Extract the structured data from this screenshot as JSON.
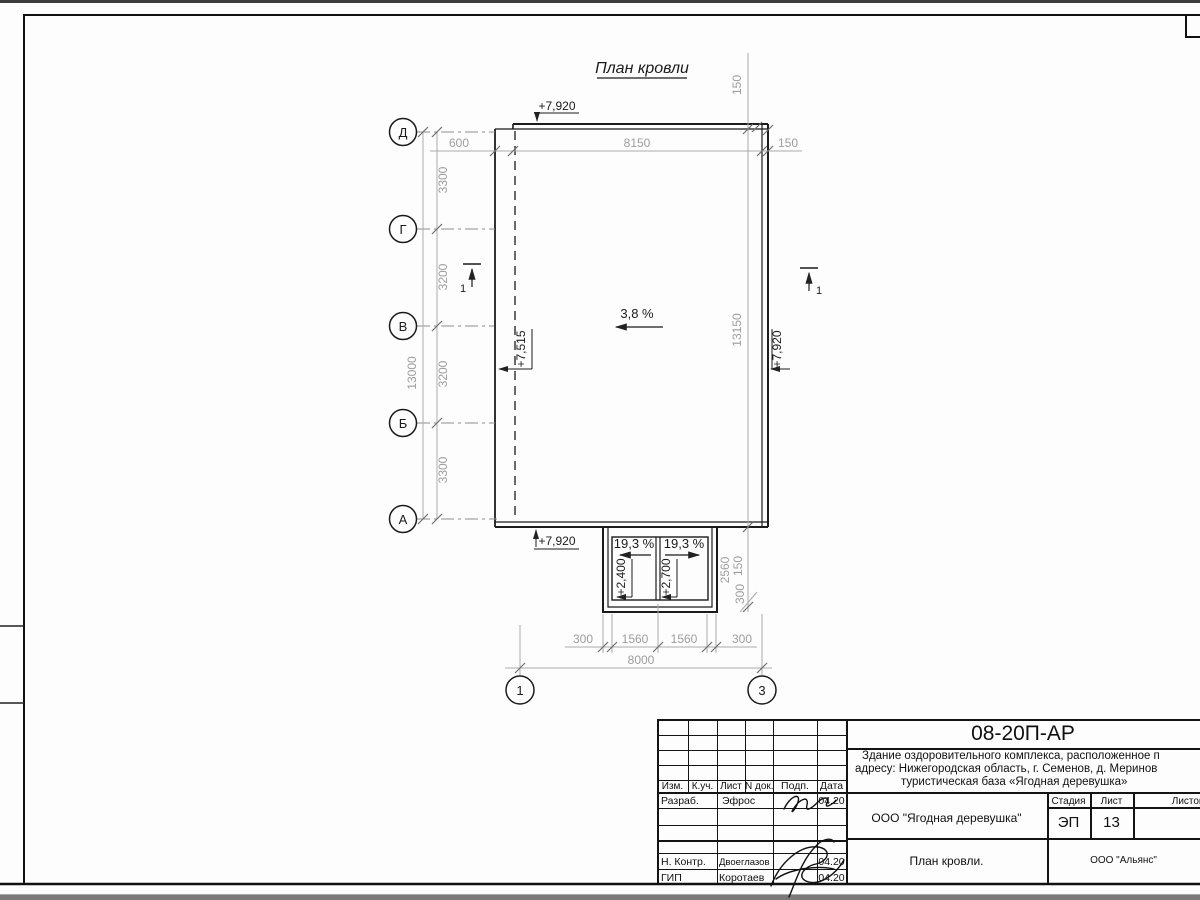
{
  "drawing": {
    "title": "План кровли",
    "slopes": {
      "main": "3,8 %",
      "canopy_left": "19,3 %",
      "canopy_right": "19,3 %"
    },
    "elevations": {
      "top": "+7,920",
      "bottom": "+7,920",
      "left": "+7,515",
      "right": "+7,920",
      "canopy_left": "+2,400",
      "canopy_right": "+2,700"
    },
    "sections": {
      "left": "1",
      "right": "1"
    },
    "axes": {
      "left": [
        "Д",
        "Г",
        "В",
        "Б",
        "А"
      ],
      "bottom": [
        "1",
        "3"
      ]
    },
    "dims": {
      "top": [
        "600",
        "8150",
        "150"
      ],
      "top_right_vertical": "150",
      "left_segments": [
        "3300",
        "3200",
        "3200",
        "3300"
      ],
      "left_total": "13000",
      "right_total": "13150",
      "canopy_right": [
        "2560",
        "150",
        "300"
      ],
      "bottom_chain": [
        "300",
        "1560",
        "1560",
        "300"
      ],
      "bottom_total": "8000"
    }
  },
  "titleblock": {
    "doc_number": "08-20П-АР",
    "description_lines": [
      "Здание оздоровительного комплекса, расположенное п",
      "адресу: Нижегородская область, г. Семенов, д. Меринов",
      "туристическая база «Ягодная деревушка»"
    ],
    "columns": {
      "izm": "Изм.",
      "kuch": "К.уч.",
      "list": "Лист",
      "ndok": "N док.",
      "podp": "Подп.",
      "data": "Дата"
    },
    "rows": [
      {
        "role": "Разраб.",
        "name": "Эфрос",
        "date": "04.20"
      },
      {
        "role": "Н. Контр.",
        "name": "Двоеглазов",
        "date": "04.20"
      },
      {
        "role": "ГИП",
        "name": "Коротаев",
        "date": "04.20"
      }
    ],
    "client": "ООО \"Ягодная деревушка\"",
    "stage_label": "Стадия",
    "sheet_label": "Лист",
    "sheets_label": "Листов",
    "stage": "ЭП",
    "sheet_number": "13",
    "sheet_title": "План кровли.",
    "organization": "ООО \"Альянс\""
  }
}
